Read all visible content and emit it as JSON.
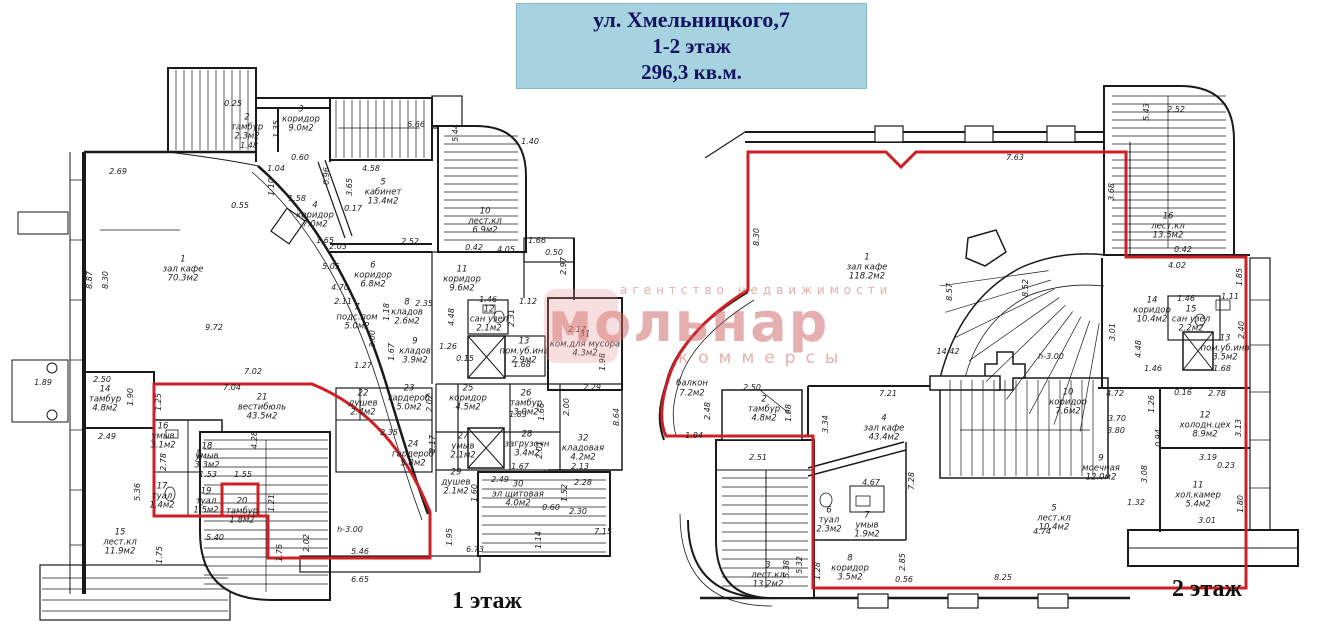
{
  "title": {
    "line1": "ул. Хмельницкого,7",
    "line2": "1-2 этаж",
    "line3": "296,3 кв.м."
  },
  "watermark": {
    "tagline": "агентство недвижимости",
    "name": "мольнар",
    "sub": "коммерсы"
  },
  "colors": {
    "highlight_red": "#cd2026",
    "wall_black": "#1a1a1a",
    "title_bg": "#a7d2e0",
    "title_text": "#131360",
    "watermark_pink": "#d06969"
  },
  "floors": [
    {
      "id": "floor1",
      "caption": "1 этаж",
      "rooms": [
        {
          "num": "1",
          "name": "зал кафе",
          "area": "70.3м2",
          "x": 183,
          "y": 270
        },
        {
          "num": "2",
          "name": "тамбур",
          "area": "2.3м2",
          "x": 247,
          "y": 128
        },
        {
          "num": "3",
          "name": "коридор",
          "area": "9.0м2",
          "x": 301,
          "y": 120
        },
        {
          "num": "4",
          "name": "коридор",
          "area": "7.0м2",
          "x": 315,
          "y": 216
        },
        {
          "num": "5",
          "name": "кабинет",
          "area": "13.4м2",
          "x": 383,
          "y": 193
        },
        {
          "num": "6",
          "name": "коридор",
          "area": "6.8м2",
          "x": 373,
          "y": 276
        },
        {
          "num": "7",
          "name": "подс.пом",
          "area": "5.0м2",
          "x": 357,
          "y": 318
        },
        {
          "num": "8",
          "name": "кладов",
          "area": "2.6м2",
          "x": 407,
          "y": 313
        },
        {
          "num": "9",
          "name": "кладов",
          "area": "3.9м2",
          "x": 415,
          "y": 352
        },
        {
          "num": "10",
          "name": "лест.кл",
          "area": "6.9м2",
          "x": 485,
          "y": 222
        },
        {
          "num": "11",
          "name": "коридор",
          "area": "9.6м2",
          "x": 462,
          "y": 280
        },
        {
          "num": "12",
          "name": "сан узел",
          "area": "2.1м2",
          "x": 489,
          "y": 320
        },
        {
          "num": "13",
          "name": "пом.уб.инв",
          "area": "2.9м2",
          "x": 524,
          "y": 352
        },
        {
          "num": "14",
          "name": "тамбур",
          "area": "4.8м2",
          "x": 105,
          "y": 400
        },
        {
          "num": "15",
          "name": "лест.кл",
          "area": "11.9м2",
          "x": 120,
          "y": 543
        },
        {
          "num": "16",
          "name": "умыв",
          "area": "3.1м2",
          "x": 163,
          "y": 437
        },
        {
          "num": "17",
          "name": "туал",
          "area": "1.4м2",
          "x": 162,
          "y": 497
        },
        {
          "num": "18",
          "name": "умыв",
          "area": "3.3м2",
          "x": 207,
          "y": 457
        },
        {
          "num": "19",
          "name": "туал",
          "area": "1.5м2",
          "x": 206,
          "y": 502
        },
        {
          "num": "20",
          "name": "тамбур",
          "area": "1.8м2",
          "x": 242,
          "y": 512
        },
        {
          "num": "21",
          "name": "вестибюль",
          "area": "43.5м2",
          "x": 262,
          "y": 408
        },
        {
          "num": "22",
          "name": "душев",
          "area": "2.4м2",
          "x": 363,
          "y": 404
        },
        {
          "num": "23",
          "name": "гардероб",
          "area": "5.0м2",
          "x": 409,
          "y": 399
        },
        {
          "num": "24",
          "name": "гардероб",
          "area": "5.8м2",
          "x": 413,
          "y": 455
        },
        {
          "num": "25",
          "name": "коридор",
          "area": "4.5м2",
          "x": 468,
          "y": 399
        },
        {
          "num": "26",
          "name": "тамбур",
          "area": "3.0м2",
          "x": 526,
          "y": 404
        },
        {
          "num": "27",
          "name": "умыв",
          "area": "2.1м2",
          "x": 463,
          "y": 447
        },
        {
          "num": "28",
          "name": "загрузочн",
          "area": "3.4м2",
          "x": 527,
          "y": 445
        },
        {
          "num": "29",
          "name": "душев",
          "area": "2.1м2",
          "x": 456,
          "y": 483
        },
        {
          "num": "30",
          "name": "эл щитовая",
          "area": "4.0м2",
          "x": 518,
          "y": 495
        },
        {
          "num": "31",
          "name": "ком.для мусора",
          "area": "4.3м2",
          "x": 585,
          "y": 345
        },
        {
          "num": "32",
          "name": "кладовая",
          "area": "4.2м2",
          "x": 583,
          "y": 449
        }
      ],
      "dims": [
        {
          "v": "2.69",
          "x": 118,
          "y": 172
        },
        {
          "v": "8.87",
          "x": 90,
          "y": 280,
          "r": 1
        },
        {
          "v": "8.30",
          "x": 106,
          "y": 280,
          "r": 1
        },
        {
          "v": "1.89",
          "x": 43,
          "y": 383
        },
        {
          "v": "0.25",
          "x": 233,
          "y": 104
        },
        {
          "v": "1.48",
          "x": 249,
          "y": 146
        },
        {
          "v": "1.35",
          "x": 277,
          "y": 129,
          "r": 1
        },
        {
          "v": "0.60",
          "x": 300,
          "y": 158
        },
        {
          "v": "4.58",
          "x": 371,
          "y": 169
        },
        {
          "v": "0.96",
          "x": 327,
          "y": 176,
          "r": 1
        },
        {
          "v": "1.04",
          "x": 276,
          "y": 169
        },
        {
          "v": "1.10",
          "x": 272,
          "y": 187,
          "r": 1
        },
        {
          "v": "1.58",
          "x": 297,
          "y": 199
        },
        {
          "v": "0.55",
          "x": 240,
          "y": 206
        },
        {
          "v": "0.17",
          "x": 353,
          "y": 209
        },
        {
          "v": "2.03",
          "x": 338,
          "y": 247
        },
        {
          "v": "6.66",
          "x": 416,
          "y": 125
        },
        {
          "v": "5.44",
          "x": 456,
          "y": 133,
          "r": 1
        },
        {
          "v": "1.40",
          "x": 530,
          "y": 142
        },
        {
          "v": "3.65",
          "x": 350,
          "y": 187,
          "r": 1
        },
        {
          "v": "2.52",
          "x": 410,
          "y": 242
        },
        {
          "v": "0.42",
          "x": 474,
          "y": 248
        },
        {
          "v": "4.05",
          "x": 506,
          "y": 250
        },
        {
          "v": "1.66",
          "x": 537,
          "y": 241
        },
        {
          "v": "0.50",
          "x": 554,
          "y": 253
        },
        {
          "v": "2.97",
          "x": 564,
          "y": 266,
          "r": 1
        },
        {
          "v": "1.65",
          "x": 325,
          "y": 241
        },
        {
          "v": "5.05",
          "x": 331,
          "y": 267
        },
        {
          "v": "4.70",
          "x": 340,
          "y": 288
        },
        {
          "v": "9.72",
          "x": 214,
          "y": 328
        },
        {
          "v": "7.02",
          "x": 253,
          "y": 372
        },
        {
          "v": "7.04",
          "x": 232,
          "y": 388
        },
        {
          "v": "2.11",
          "x": 343,
          "y": 302
        },
        {
          "v": "2.35",
          "x": 424,
          "y": 304
        },
        {
          "v": "1.18",
          "x": 387,
          "y": 312,
          "r": 1
        },
        {
          "v": "4.48",
          "x": 452,
          "y": 317,
          "r": 1
        },
        {
          "v": "3.00",
          "x": 373,
          "y": 339,
          "r": 1
        },
        {
          "v": "1.67",
          "x": 392,
          "y": 352,
          "r": 1
        },
        {
          "v": "1.27",
          "x": 363,
          "y": 366
        },
        {
          "v": "0.15",
          "x": 465,
          "y": 359
        },
        {
          "v": "1.26",
          "x": 448,
          "y": 347
        },
        {
          "v": "1.46",
          "x": 488,
          "y": 300
        },
        {
          "v": "1.12",
          "x": 528,
          "y": 302
        },
        {
          "v": "2.31",
          "x": 512,
          "y": 318,
          "r": 1
        },
        {
          "v": "2.17",
          "x": 577,
          "y": 330
        },
        {
          "v": "2.29",
          "x": 592,
          "y": 388
        },
        {
          "v": "1.98",
          "x": 603,
          "y": 362,
          "r": 1
        },
        {
          "v": "1.68",
          "x": 522,
          "y": 365
        },
        {
          "v": "2.50",
          "x": 102,
          "y": 380
        },
        {
          "v": "1.90",
          "x": 131,
          "y": 397,
          "r": 1
        },
        {
          "v": "2.49",
          "x": 107,
          "y": 437
        },
        {
          "v": "1.25",
          "x": 159,
          "y": 402,
          "r": 1
        },
        {
          "v": "2.78",
          "x": 164,
          "y": 462,
          "r": 1
        },
        {
          "v": "1.53",
          "x": 208,
          "y": 475
        },
        {
          "v": "1.55",
          "x": 243,
          "y": 475
        },
        {
          "v": "4.28",
          "x": 255,
          "y": 440,
          "r": 1
        },
        {
          "v": "5.36",
          "x": 138,
          "y": 492,
          "r": 1
        },
        {
          "v": "5.40",
          "x": 215,
          "y": 538
        },
        {
          "v": "1.21",
          "x": 272,
          "y": 503,
          "r": 1
        },
        {
          "v": "1.75",
          "x": 160,
          "y": 555,
          "r": 1
        },
        {
          "v": "1.76",
          "x": 280,
          "y": 553,
          "r": 1
        },
        {
          "v": "2.02",
          "x": 307,
          "y": 543,
          "r": 1
        },
        {
          "v": "5.46",
          "x": 360,
          "y": 552
        },
        {
          "v": "6.65",
          "x": 360,
          "y": 580
        },
        {
          "v": "1.95",
          "x": 450,
          "y": 537,
          "r": 1
        },
        {
          "v": "6.73",
          "x": 475,
          "y": 550
        },
        {
          "v": "7.15",
          "x": 603,
          "y": 532
        },
        {
          "v": "1.14",
          "x": 539,
          "y": 540,
          "r": 1
        },
        {
          "v": "2.49",
          "x": 500,
          "y": 480
        },
        {
          "v": "1.60",
          "x": 475,
          "y": 493,
          "r": 1
        },
        {
          "v": "1.52",
          "x": 565,
          "y": 493,
          "r": 1
        },
        {
          "v": "0.60",
          "x": 551,
          "y": 508
        },
        {
          "v": "2.30",
          "x": 578,
          "y": 512
        },
        {
          "v": "1.67",
          "x": 520,
          "y": 467
        },
        {
          "v": "2.01",
          "x": 540,
          "y": 450,
          "r": 1
        },
        {
          "v": "2.13",
          "x": 580,
          "y": 467
        },
        {
          "v": "2.00",
          "x": 567,
          "y": 407,
          "r": 1
        },
        {
          "v": "1.66",
          "x": 542,
          "y": 412,
          "r": 1
        },
        {
          "v": "1.83",
          "x": 518,
          "y": 415
        },
        {
          "v": "8.64",
          "x": 617,
          "y": 417,
          "r": 1
        },
        {
          "v": "2.28",
          "x": 583,
          "y": 483
        },
        {
          "v": "2.17",
          "x": 433,
          "y": 444,
          "r": 1
        },
        {
          "v": "2.02",
          "x": 430,
          "y": 403,
          "r": 1
        },
        {
          "v": "2.35",
          "x": 389,
          "y": 433
        },
        {
          "v": "h-3.00",
          "x": 350,
          "y": 530
        }
      ]
    },
    {
      "id": "floor2",
      "caption": "2 этаж",
      "rooms": [
        {
          "num": "1",
          "name": "зал кафе",
          "area": "118.2м2",
          "x": 867,
          "y": 268
        },
        {
          "num": "2",
          "name": "тамбур",
          "area": "4.8м2",
          "x": 764,
          "y": 410
        },
        {
          "num": "3",
          "name": "лест.кл",
          "area": "13.2м2",
          "x": 768,
          "y": 576
        },
        {
          "num": "4",
          "name": "зал кафе",
          "area": "43.4м2",
          "x": 884,
          "y": 429
        },
        {
          "num": "5",
          "name": "лест.кл",
          "area": "10.4м2",
          "x": 1054,
          "y": 519
        },
        {
          "num": "6",
          "name": "туал",
          "area": "2.3м2",
          "x": 829,
          "y": 521
        },
        {
          "num": "7",
          "name": "умыв",
          "area": "1.9м2",
          "x": 867,
          "y": 526
        },
        {
          "num": "8",
          "name": "коридор",
          "area": "3.5м2",
          "x": 850,
          "y": 569
        },
        {
          "num": "9",
          "name": "моечная",
          "area": "12.0м2",
          "x": 1101,
          "y": 469
        },
        {
          "num": "10",
          "name": "коридор",
          "area": "7.6м2",
          "x": 1068,
          "y": 403
        },
        {
          "num": "11",
          "name": "хол.камер",
          "area": "5.4м2",
          "x": 1198,
          "y": 496
        },
        {
          "num": "12",
          "name": "холодн.цех",
          "area": "8.9м2",
          "x": 1205,
          "y": 426
        },
        {
          "num": "13",
          "name": "пом.уб.инв",
          "area": "3.5м2",
          "x": 1225,
          "y": 349
        },
        {
          "num": "14",
          "name": "коридор",
          "area": "10.4м2",
          "x": 1152,
          "y": 311
        },
        {
          "num": "15",
          "name": "сан узел",
          "area": "2.2м2",
          "x": 1191,
          "y": 320
        },
        {
          "num": "16",
          "name": "лест.кл",
          "area": "13.5м2",
          "x": 1168,
          "y": 227
        },
        {
          "num": "",
          "name": "балкон",
          "area": "7.2м2",
          "x": 692,
          "y": 389
        }
      ],
      "dims": [
        {
          "v": "8.30",
          "x": 757,
          "y": 237,
          "r": 1
        },
        {
          "v": "7.63",
          "x": 1015,
          "y": 158
        },
        {
          "v": "3.68",
          "x": 1112,
          "y": 192,
          "r": 1
        },
        {
          "v": "8.57",
          "x": 950,
          "y": 292,
          "r": 1
        },
        {
          "v": "8.52",
          "x": 1026,
          "y": 288,
          "r": 1
        },
        {
          "v": "14.42",
          "x": 948,
          "y": 352
        },
        {
          "v": "h-3.00",
          "x": 1051,
          "y": 357
        },
        {
          "v": "5.43",
          "x": 1147,
          "y": 112,
          "r": 1
        },
        {
          "v": "2.52",
          "x": 1176,
          "y": 110
        },
        {
          "v": "0.42",
          "x": 1183,
          "y": 250
        },
        {
          "v": "4.02",
          "x": 1177,
          "y": 266
        },
        {
          "v": "1.85",
          "x": 1240,
          "y": 277,
          "r": 1
        },
        {
          "v": "1.46",
          "x": 1186,
          "y": 299
        },
        {
          "v": "1.11",
          "x": 1230,
          "y": 297
        },
        {
          "v": "2.40",
          "x": 1242,
          "y": 330,
          "r": 1
        },
        {
          "v": "3.01",
          "x": 1113,
          "y": 332,
          "r": 1
        },
        {
          "v": "4.48",
          "x": 1139,
          "y": 349,
          "r": 1
        },
        {
          "v": "1.46",
          "x": 1153,
          "y": 369
        },
        {
          "v": "1.68",
          "x": 1222,
          "y": 369
        },
        {
          "v": "4.72",
          "x": 1115,
          "y": 394
        },
        {
          "v": "1.26",
          "x": 1152,
          "y": 404,
          "r": 1
        },
        {
          "v": "3.70",
          "x": 1117,
          "y": 419
        },
        {
          "v": "3.80",
          "x": 1116,
          "y": 431
        },
        {
          "v": "0.94",
          "x": 1159,
          "y": 438,
          "r": 1
        },
        {
          "v": "0.16",
          "x": 1183,
          "y": 393
        },
        {
          "v": "2.78",
          "x": 1217,
          "y": 394
        },
        {
          "v": "3.13",
          "x": 1239,
          "y": 428,
          "r": 1
        },
        {
          "v": "3.19",
          "x": 1208,
          "y": 458
        },
        {
          "v": "0.23",
          "x": 1226,
          "y": 466
        },
        {
          "v": "3.08",
          "x": 1145,
          "y": 474,
          "r": 1
        },
        {
          "v": "1.32",
          "x": 1136,
          "y": 503
        },
        {
          "v": "3.01",
          "x": 1207,
          "y": 521
        },
        {
          "v": "1.80",
          "x": 1241,
          "y": 504,
          "r": 1
        },
        {
          "v": "7.21",
          "x": 888,
          "y": 394
        },
        {
          "v": "3.34",
          "x": 826,
          "y": 424,
          "r": 1
        },
        {
          "v": "4.67",
          "x": 871,
          "y": 483
        },
        {
          "v": "7.28",
          "x": 912,
          "y": 481,
          "r": 1
        },
        {
          "v": "4.74",
          "x": 1042,
          "y": 532
        },
        {
          "v": "2.85",
          "x": 903,
          "y": 562,
          "r": 1
        },
        {
          "v": "0.56",
          "x": 904,
          "y": 580
        },
        {
          "v": "8.25",
          "x": 1003,
          "y": 578
        },
        {
          "v": "1.28",
          "x": 818,
          "y": 571,
          "r": 1
        },
        {
          "v": "5.38",
          "x": 787,
          "y": 569,
          "r": 1
        },
        {
          "v": "5.32",
          "x": 800,
          "y": 565,
          "r": 1
        },
        {
          "v": "2.51",
          "x": 758,
          "y": 458
        },
        {
          "v": "2.50",
          "x": 752,
          "y": 388
        },
        {
          "v": "1.98",
          "x": 789,
          "y": 413,
          "r": 1
        },
        {
          "v": "2.48",
          "x": 708,
          "y": 411,
          "r": 1
        },
        {
          "v": "1.84",
          "x": 694,
          "y": 436
        }
      ]
    }
  ]
}
